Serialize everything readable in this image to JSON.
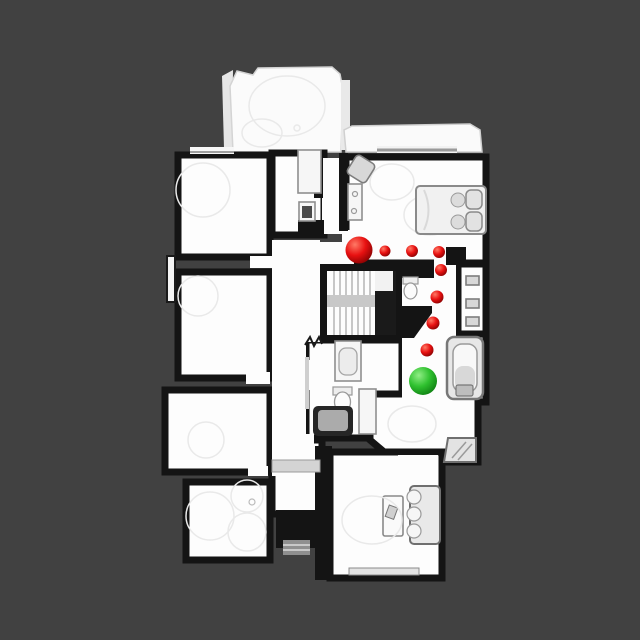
{
  "scene": {
    "background_color": "#414141",
    "floor_color": "#fdfdfd",
    "wall_color": "#141414"
  },
  "markers": {
    "start": {
      "x": 359,
      "y": 250,
      "r": 13.5
    },
    "waypoints": [
      {
        "x": 385,
        "y": 251,
        "r": 5.5
      },
      {
        "x": 412,
        "y": 251,
        "r": 6
      },
      {
        "x": 439,
        "y": 252,
        "r": 6
      },
      {
        "x": 441,
        "y": 270,
        "r": 6
      },
      {
        "x": 437,
        "y": 297,
        "r": 6.5
      },
      {
        "x": 433,
        "y": 323,
        "r": 6.5
      },
      {
        "x": 427,
        "y": 350,
        "r": 6.5
      }
    ],
    "goal": {
      "x": 423,
      "y": 381,
      "r": 14
    },
    "styles": {
      "start": [
        "#ff7a66",
        "#e81111",
        "#7e0000"
      ],
      "waypoint": [
        "#ff7a66",
        "#e81111",
        "#7e0000"
      ],
      "goal": [
        "#90ee85",
        "#2fc12f",
        "#0c7a10"
      ]
    }
  }
}
